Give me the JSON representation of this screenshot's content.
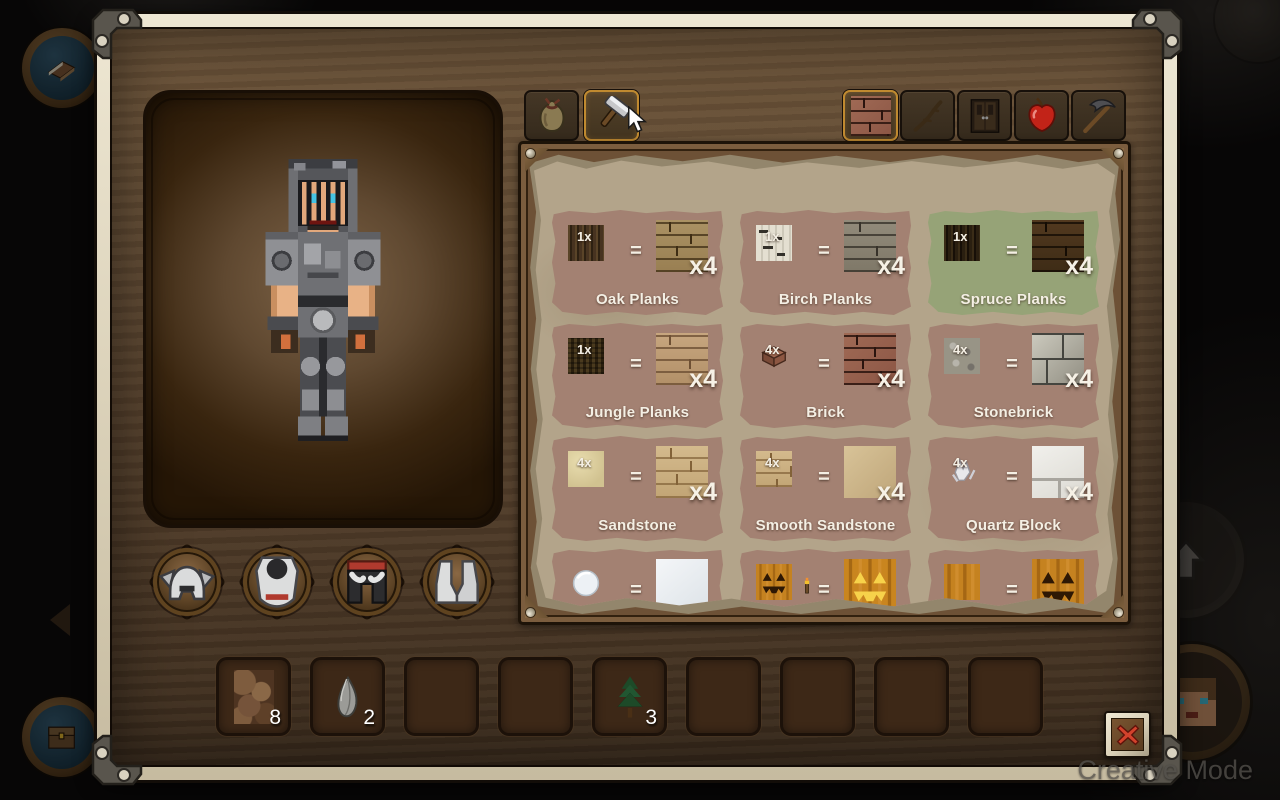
{
  "hud": {
    "creative_mode_label": "Creative Mode",
    "side_buttons": {
      "journal": {
        "icon": "book"
      },
      "storage": {
        "icon": "chest"
      },
      "back": {
        "icon": "chevron-left"
      },
      "jump": {
        "icon": "arrow-up"
      },
      "player": {
        "icon": "player-avatar"
      }
    }
  },
  "crafting_window": {
    "left_tabs": [
      {
        "id": "inventory",
        "icon": "bag",
        "selected": false
      },
      {
        "id": "crafting",
        "icon": "hammer",
        "selected": true
      }
    ],
    "category_tabs": [
      {
        "id": "building-blocks",
        "icon": "brick-block",
        "selected": true
      },
      {
        "id": "sticks",
        "icon": "stick",
        "selected": false
      },
      {
        "id": "doors",
        "icon": "door",
        "selected": false
      },
      {
        "id": "food",
        "icon": "apple",
        "selected": false
      },
      {
        "id": "tools",
        "icon": "pickaxe",
        "selected": false
      }
    ],
    "armor_slots": [
      {
        "id": "helmet",
        "icon": "iron-helmet"
      },
      {
        "id": "chestplate",
        "icon": "iron-chestplate"
      },
      {
        "id": "leggings",
        "icon": "iron-leggings"
      },
      {
        "id": "boots",
        "icon": "iron-boots"
      }
    ],
    "recipes": {
      "equals": "=",
      "cards": [
        {
          "name": "Oak Planks",
          "ingredient_icon": "oak-log",
          "ingredient_count": "1x",
          "result_icon": "oak-planks",
          "result_count": "x4",
          "highlighted": false
        },
        {
          "name": "Birch Planks",
          "ingredient_icon": "birch-log",
          "ingredient_count": "1x",
          "result_icon": "birch-planks",
          "result_count": "x4",
          "highlighted": false
        },
        {
          "name": "Spruce Planks",
          "ingredient_icon": "spruce-log",
          "ingredient_count": "1x",
          "result_icon": "spruce-planks",
          "result_count": "x4",
          "highlighted": true
        },
        {
          "name": "Jungle Planks",
          "ingredient_icon": "jungle-log",
          "ingredient_count": "1x",
          "result_icon": "jungle-planks",
          "result_count": "x4",
          "highlighted": false
        },
        {
          "name": "Brick",
          "ingredient_icon": "brick-item",
          "ingredient_count": "4x",
          "result_icon": "brick-block",
          "result_count": "x4",
          "highlighted": false
        },
        {
          "name": "Stonebrick",
          "ingredient_icon": "stone",
          "ingredient_count": "4x",
          "result_icon": "stone-bricks",
          "result_count": "x4",
          "highlighted": false
        },
        {
          "name": "Sandstone",
          "ingredient_icon": "sand",
          "ingredient_count": "4x",
          "result_icon": "sandstone",
          "result_count": "x4",
          "highlighted": false
        },
        {
          "name": "Smooth Sandstone",
          "ingredient_icon": "sandstone",
          "ingredient_count": "4x",
          "result_icon": "smooth-sandstone",
          "result_count": "x4",
          "highlighted": false
        },
        {
          "name": "Quartz Block",
          "ingredient_icon": "quartz-item",
          "ingredient_count": "4x",
          "result_icon": "quartz-block",
          "result_count": "x4",
          "highlighted": false
        }
      ],
      "partial_cards": [
        {
          "ingredient_icon": "snowball",
          "result_icon": "snow-block"
        },
        {
          "ingredient_icon": "carved-pumpkin",
          "extra_icon": "torch",
          "result_icon": "jack-o-lantern"
        },
        {
          "ingredient_icon": "pumpkin",
          "result_icon": "carved-pumpkin"
        }
      ]
    },
    "hotbar": [
      {
        "icon": "dirt",
        "count": "8"
      },
      {
        "icon": "flint",
        "count": "2"
      },
      {},
      {},
      {
        "icon": "spruce-sapling",
        "count": "3"
      },
      {},
      {},
      {},
      {}
    ],
    "close_button": {
      "icon": "close-x"
    }
  }
}
